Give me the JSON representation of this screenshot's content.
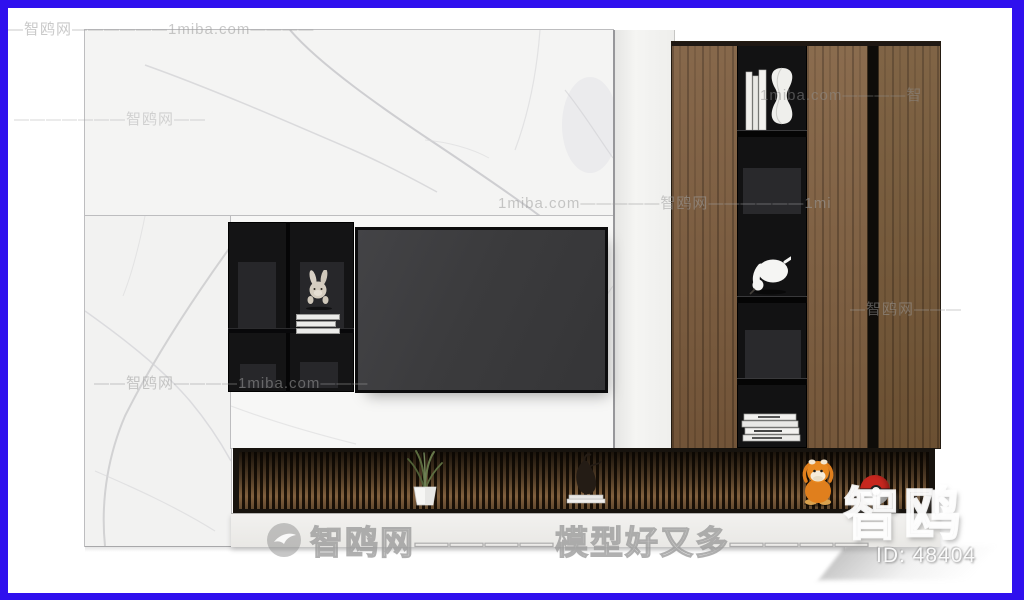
{
  "page": {
    "frame_color": "#2f10ee",
    "background": "#ffffff"
  },
  "watermarks": {
    "rows": [
      {
        "text": "—智鸥网——————1miba.com————"
      },
      {
        "text": "1miba.com————智"
      },
      {
        "text": "———————智鸥网——"
      },
      {
        "text": "1miba.com—————智鸥网——————1mi"
      },
      {
        "text": "—智鸥网———"
      },
      {
        "text": "——智鸥网————1miba.com———"
      }
    ],
    "bottom_brand": "智鸥网————模型好又多————",
    "logo_large": "智鸥",
    "model_id": "ID: 48404"
  },
  "palette": {
    "frame_accent": "#2f10ee",
    "wood": "#7d5c3d",
    "shelf_black": "#141415",
    "tv_screen": "#3c3c3e",
    "marble": "#f4f4f3",
    "slat_wood": "#8b6843",
    "pokeball_red": "#c8271f",
    "duck_orange": "#e0801c"
  }
}
